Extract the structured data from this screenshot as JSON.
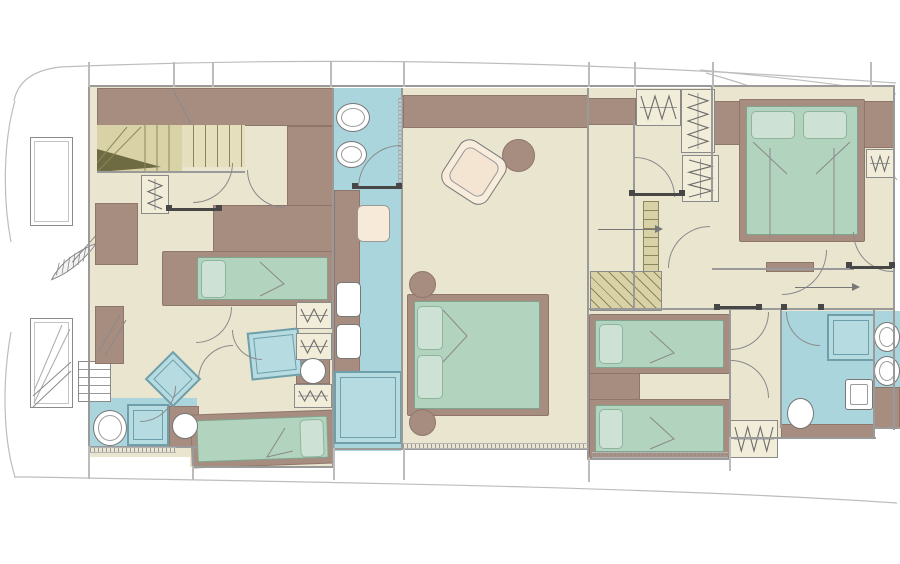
{
  "canvas": {
    "w": 900,
    "h": 564,
    "bg": "#ffffff"
  },
  "palette": {
    "cream": "#e9e5cf",
    "cream2": "#f1edd9",
    "brown": "#a78c80",
    "brown_edge": "#8f766b",
    "green": "#b2d3bd",
    "green_edge": "#7fa590",
    "pillow": "#cde2d5",
    "pillow_edge": "#8fb49e",
    "blue": "#aad5dc",
    "blue_deep": "#b6dbe1",
    "shower_edge": "#6f9faa",
    "khaki": "#d9d2a6",
    "khaki_light": "#e6dfbd",
    "khaki_dark": "#6e6a42",
    "khaki_line": "#8b865c",
    "wall": "#9a9a9a",
    "wall_light": "#bcbcbc",
    "line": "#8a8a8a",
    "dark": "#474747",
    "white": "#ffffff",
    "seat": "#f7ead9",
    "hull": "#bdbdbd",
    "arrow": "#777777"
  },
  "hull_paths": [
    {
      "n": "hull-sheer-top",
      "d": "M896,83 C560,59 300,57 60,67 C35,70 18,80 14,101"
    },
    {
      "n": "hull-bow-upper",
      "d": "M15,101 C4,138 2,195 11,242"
    },
    {
      "n": "hull-bow-lower",
      "d": "M11,332 C2,382 3,438 15,477"
    },
    {
      "n": "hull-sheer-bottom",
      "d": "M897,503 C640,486 300,482 30,477 L14,477"
    },
    {
      "n": "hull-stern-line",
      "d": "M700,70 C790,78 858,87 896,94"
    },
    {
      "n": "hull-chine",
      "d": "M706,73 C800,98 868,138 897,180"
    }
  ],
  "floors": [
    {
      "n": "forward-cabin-floor",
      "x": 90,
      "y": 87,
      "w": 243,
      "h": 370,
      "f": "cream"
    },
    {
      "n": "forward-ext-floor",
      "x": 190,
      "y": 400,
      "w": 143,
      "h": 67,
      "f": "cream"
    },
    {
      "n": "master-bath-floor",
      "x": 334,
      "y": 88,
      "w": 67,
      "h": 363,
      "f": "blue"
    },
    {
      "n": "master-cabin-floor",
      "x": 403,
      "y": 88,
      "w": 185,
      "h": 362,
      "f": "cream"
    },
    {
      "n": "stair-lobby-floor",
      "x": 588,
      "y": 88,
      "w": 124,
      "h": 222,
      "f": "cream"
    },
    {
      "n": "corridor-floor",
      "x": 634,
      "y": 198,
      "w": 260,
      "h": 113,
      "f": "cream"
    },
    {
      "n": "vip-cabin-floor",
      "x": 712,
      "y": 87,
      "w": 182,
      "h": 184,
      "f": "cream"
    },
    {
      "n": "twin-cabin-floor",
      "x": 588,
      "y": 310,
      "w": 142,
      "h": 150,
      "f": "cream"
    },
    {
      "n": "aft-lobby-floor",
      "x": 730,
      "y": 310,
      "w": 52,
      "h": 128,
      "f": "cream"
    },
    {
      "n": "aft-bath-floor",
      "x": 781,
      "y": 311,
      "w": 94,
      "h": 116,
      "f": "blue"
    },
    {
      "n": "starboard-bath-floor",
      "x": 874,
      "y": 311,
      "w": 26,
      "h": 118,
      "f": "blue"
    },
    {
      "n": "forward-bath-floor",
      "x": 90,
      "y": 398,
      "w": 107,
      "h": 50,
      "f": "blue"
    }
  ],
  "blocks": [
    {
      "n": "forward-cabinet-band",
      "x": 97,
      "y": 88,
      "w": 236,
      "h": 38
    },
    {
      "n": "forward-cabinet-right",
      "x": 287,
      "y": 126,
      "w": 46,
      "h": 106
    },
    {
      "n": "forward-cabinet-left",
      "x": 95,
      "y": 203,
      "w": 43,
      "h": 62
    },
    {
      "n": "forward-mid-cabinet",
      "x": 213,
      "y": 205,
      "w": 120,
      "h": 48
    },
    {
      "n": "mirror-panel",
      "x": 95,
      "y": 306,
      "w": 29,
      "h": 58
    },
    {
      "n": "master-cabinet-band",
      "x": 403,
      "y": 95,
      "w": 185,
      "h": 33
    },
    {
      "n": "master-bath-counter",
      "x": 334,
      "y": 190,
      "w": 26,
      "h": 182
    },
    {
      "n": "lobby-cabinet",
      "x": 588,
      "y": 98,
      "w": 48,
      "h": 27
    },
    {
      "n": "vip-headboard-left",
      "x": 712,
      "y": 101,
      "w": 29,
      "h": 44
    },
    {
      "n": "vip-headboard-right",
      "x": 860,
      "y": 101,
      "w": 34,
      "h": 47
    },
    {
      "n": "vip-bench",
      "x": 766,
      "y": 262,
      "w": 48,
      "h": 10
    },
    {
      "n": "twin-nightstand",
      "x": 589,
      "y": 372,
      "w": 51,
      "h": 29
    },
    {
      "n": "aft-bath-counter",
      "x": 781,
      "y": 424,
      "w": 94,
      "h": 15
    },
    {
      "n": "starboard-bath-counter",
      "x": 873,
      "y": 387,
      "w": 27,
      "h": 42
    },
    {
      "n": "toilet-surround-forward",
      "x": 169,
      "y": 406,
      "w": 30,
      "h": 42
    },
    {
      "n": "toilet-surround-mid",
      "x": 296,
      "y": 354,
      "w": 34,
      "h": 30
    }
  ],
  "stairs": [
    {
      "n": "forward-stairs-winder",
      "t": "winder",
      "x": 97,
      "y": 125,
      "w": 85,
      "h": 47
    },
    {
      "n": "forward-stairs-treads",
      "t": "tv",
      "x": 182,
      "y": 125,
      "w": 63,
      "h": 42
    },
    {
      "n": "aft-stairs-strip",
      "t": "th",
      "x": 643,
      "y": 201,
      "w": 16,
      "h": 71
    },
    {
      "n": "aft-staircase",
      "t": "hatch",
      "x": 590,
      "y": 271,
      "w": 72,
      "h": 40
    }
  ],
  "beds": [
    {
      "n": "forward-single-bed",
      "x": 162,
      "y": 251,
      "w": 171,
      "h": 55,
      "mi": [
        34,
        5,
        4,
        5
      ],
      "p": [
        {
          "x": 38,
          "y": 8,
          "w": 25,
          "h": 38
        }
      ]
    },
    {
      "n": "forward-lower-bed",
      "x": 191,
      "y": 412,
      "w": 143,
      "h": 54,
      "r": -2,
      "mi": [
        5,
        5,
        5,
        5
      ],
      "p": [
        {
          "x": 108,
          "y": 8,
          "w": 24,
          "h": 38
        }
      ]
    },
    {
      "n": "master-bed",
      "x": 407,
      "y": 294,
      "w": 142,
      "h": 122,
      "mi": [
        6,
        6,
        8,
        6
      ],
      "p": [
        {
          "x": 9,
          "y": 11,
          "w": 26,
          "h": 44
        },
        {
          "x": 9,
          "y": 60,
          "w": 26,
          "h": 44
        }
      ]
    },
    {
      "n": "vip-bed",
      "x": 739,
      "y": 99,
      "w": 126,
      "h": 143,
      "mi": [
        6,
        6,
        6,
        6
      ],
      "p": [
        {
          "x": 11,
          "y": 11,
          "w": 44,
          "h": 28
        },
        {
          "x": 63,
          "y": 11,
          "w": 44,
          "h": 28
        }
      ]
    },
    {
      "n": "twin-bed-upper",
      "x": 589,
      "y": 314,
      "w": 141,
      "h": 60,
      "mi": [
        5,
        5,
        5,
        5
      ],
      "p": [
        {
          "x": 9,
          "y": 9,
          "w": 24,
          "h": 40
        }
      ]
    },
    {
      "n": "twin-bed-lower",
      "x": 589,
      "y": 399,
      "w": 141,
      "h": 59,
      "mi": [
        5,
        5,
        5,
        5
      ],
      "p": [
        {
          "x": 9,
          "y": 9,
          "w": 24,
          "h": 40
        }
      ]
    }
  ],
  "closets": [
    {
      "n": "forward-wardrobe",
      "x": 141,
      "y": 175,
      "w": 28,
      "h": 39,
      "d": "v"
    },
    {
      "n": "mid-wardrobe-1",
      "x": 296,
      "y": 302,
      "w": 36,
      "h": 27,
      "d": "h"
    },
    {
      "n": "mid-wardrobe-2",
      "x": 296,
      "y": 333,
      "w": 36,
      "h": 27,
      "d": "h"
    },
    {
      "n": "mid-wardrobe-3",
      "x": 294,
      "y": 384,
      "w": 38,
      "h": 24,
      "d": "h"
    },
    {
      "n": "lobby-closet-1",
      "x": 636,
      "y": 89,
      "w": 45,
      "h": 37,
      "d": "h"
    },
    {
      "n": "lobby-closet-2",
      "x": 681,
      "y": 89,
      "w": 34,
      "h": 64,
      "d": "v"
    },
    {
      "n": "lobby-closet-3",
      "x": 682,
      "y": 155,
      "w": 37,
      "h": 47,
      "d": "v"
    },
    {
      "n": "twin-wardrobe",
      "x": 730,
      "y": 420,
      "w": 48,
      "h": 38,
      "d": "h"
    },
    {
      "n": "vip-closet",
      "x": 866,
      "y": 149,
      "w": 28,
      "h": 29,
      "d": "h"
    }
  ],
  "showers": [
    {
      "n": "forward-shower",
      "x": 127,
      "y": 404,
      "w": 42,
      "h": 42
    },
    {
      "n": "master-shower",
      "x": 334,
      "y": 371,
      "w": 68,
      "h": 73
    },
    {
      "n": "aft-shower",
      "x": 827,
      "y": 314,
      "w": 48,
      "h": 47
    },
    {
      "n": "mid-shower-diamond",
      "x": 153,
      "y": 359,
      "w": 40,
      "h": 40,
      "r": 45
    },
    {
      "n": "mid-shower-quad",
      "x": 249,
      "y": 330,
      "w": 52,
      "h": 48,
      "r": -6
    }
  ],
  "sinks": [
    {
      "n": "forward-sink",
      "t": "oval",
      "x": 93,
      "y": 410,
      "w": 34,
      "h": 36
    },
    {
      "n": "master-sink-1",
      "t": "oval",
      "x": 336,
      "y": 103,
      "w": 34,
      "h": 29
    },
    {
      "n": "master-sink-2",
      "t": "oval",
      "x": 336,
      "y": 141,
      "w": 31,
      "h": 27
    },
    {
      "n": "starboard-sink-1",
      "t": "oval",
      "x": 874,
      "y": 322,
      "w": 26,
      "h": 30
    },
    {
      "n": "starboard-sink-2",
      "t": "oval",
      "x": 874,
      "y": 356,
      "w": 26,
      "h": 30
    },
    {
      "n": "aft-vanity-sink",
      "t": "sq",
      "x": 845,
      "y": 379,
      "w": 28,
      "h": 31
    }
  ],
  "toilets": [
    {
      "n": "forward-toilet",
      "t": "circle",
      "x": 172,
      "y": 413,
      "w": 26,
      "h": 26
    },
    {
      "n": "mid-toilet",
      "t": "circle",
      "x": 300,
      "y": 358,
      "w": 26,
      "h": 26
    },
    {
      "n": "aft-toilet",
      "t": "oval",
      "x": 787,
      "y": 398,
      "w": 27,
      "h": 31
    },
    {
      "n": "master-wc",
      "t": "fix",
      "x": 336,
      "y": 282,
      "w": 25,
      "h": 35
    },
    {
      "n": "master-bidet",
      "t": "fix",
      "x": 336,
      "y": 324,
      "w": 25,
      "h": 35
    }
  ],
  "round_tables": [
    {
      "n": "master-side-table-top",
      "x": 409,
      "y": 271,
      "d": 27
    },
    {
      "n": "master-side-table-bottom",
      "x": 409,
      "y": 409,
      "d": 27
    },
    {
      "n": "master-coffee-table",
      "x": 502,
      "y": 139,
      "d": 33
    }
  ],
  "seats": [
    {
      "n": "master-bath-seat",
      "t": "seat",
      "x": 357,
      "y": 205,
      "w": 33,
      "h": 37
    },
    {
      "n": "master-armchair",
      "t": "chair",
      "x": 447,
      "y": 145,
      "w": 54,
      "h": 54,
      "r": 33
    }
  ],
  "lockers": [
    {
      "n": "bow-locker-1",
      "t": "locker",
      "x": 30,
      "y": 137,
      "w": 43,
      "h": 89
    },
    {
      "n": "bow-locker-2",
      "t": "locker",
      "x": 30,
      "y": 318,
      "w": 43,
      "h": 90,
      "diag": true
    },
    {
      "n": "bow-ladder",
      "t": "ladder",
      "x": 78,
      "y": 361,
      "w": 33,
      "h": 41
    }
  ],
  "feather": {
    "n": "bow-hatch-grating",
    "x": 44,
    "y": 244,
    "w": 62,
    "h": 34,
    "rot": -25,
    "outline": "M2,24 Q22,8 58,10 Q28,26 2,24 Z",
    "stem": "M28,17 L60,3",
    "hatch": "M8,22 L16,12 M14,23 L22,11 M20,23 L28,11 M26,23 L34,10 M32,22 L40,10 M38,21 L46,10"
  },
  "walls_h": [
    [
      88,
      85,
      807
    ],
    [
      97,
      171,
      148
    ],
    [
      88,
      446,
      110
    ],
    [
      192,
      466,
      142
    ],
    [
      333,
      448,
      256
    ],
    [
      588,
      458,
      143
    ],
    [
      729,
      437,
      147
    ],
    [
      874,
      427,
      26
    ],
    [
      588,
      308,
      307
    ],
    [
      712,
      268,
      142
    ]
  ],
  "walls_v": [
    [
      88,
      85,
      363
    ],
    [
      332,
      88,
      360
    ],
    [
      401,
      88,
      361
    ],
    [
      587,
      88,
      372
    ],
    [
      633,
      120,
      190
    ],
    [
      711,
      85,
      117
    ],
    [
      729,
      310,
      129
    ],
    [
      780,
      310,
      118
    ],
    [
      873,
      310,
      119
    ],
    [
      893,
      85,
      345
    ],
    [
      192,
      446,
      22
    ],
    [
      332,
      448,
      18
    ],
    [
      587,
      448,
      12
    ],
    [
      729,
      437,
      23
    ],
    [
      873,
      427,
      12
    ]
  ],
  "stubs_top": [
    88,
    173,
    212,
    330,
    403,
    588,
    634,
    712,
    870
  ],
  "stubs_bottom": [
    [
      88,
      446,
      33
    ],
    [
      192,
      466,
      14
    ],
    [
      333,
      448,
      32
    ],
    [
      403,
      448,
      32
    ],
    [
      588,
      458,
      24
    ],
    [
      729,
      437,
      34
    ]
  ],
  "door_arcs": [
    {
      "cx": 193,
      "cy": 163,
      "r": 40,
      "p": "tl"
    },
    {
      "cx": 285,
      "cy": 170,
      "r": 38,
      "p": "tr"
    },
    {
      "cx": 401,
      "cy": 188,
      "r": 43,
      "p": "br"
    },
    {
      "cx": 635,
      "cy": 197,
      "r": 40,
      "p": "bl"
    },
    {
      "cx": 710,
      "cy": 268,
      "r": 42,
      "p": "br"
    },
    {
      "cx": 731,
      "cy": 312,
      "r": 38,
      "p": "tl"
    },
    {
      "cx": 820,
      "cy": 312,
      "r": 34,
      "p": "tr"
    },
    {
      "cx": 782,
      "cy": 250,
      "r": 45,
      "p": "tl"
    },
    {
      "cx": 893,
      "cy": 232,
      "r": 40,
      "p": "tr"
    },
    {
      "cx": 731,
      "cy": 398,
      "r": 38,
      "p": "bl"
    },
    {
      "cx": 196,
      "cy": 307,
      "r": 36,
      "p": "tl"
    },
    {
      "cx": 233,
      "cy": 380,
      "r": 35,
      "p": "br"
    },
    {
      "cx": 262,
      "cy": 330,
      "r": 30,
      "p": "tr"
    },
    {
      "cx": 140,
      "cy": 386,
      "r": 36,
      "p": "tl"
    }
  ],
  "door_bars": [
    [
      358,
      186,
      44
    ],
    [
      633,
      193,
      50
    ],
    [
      170,
      208,
      48
    ],
    [
      718,
      306,
      42
    ],
    [
      850,
      266,
      42
    ]
  ],
  "door_posts": [
    [
      352,
      183
    ],
    [
      396,
      183
    ],
    [
      629,
      190
    ],
    [
      679,
      190
    ],
    [
      714,
      304
    ],
    [
      756,
      304
    ],
    [
      781,
      304
    ],
    [
      818,
      304
    ],
    [
      846,
      262
    ],
    [
      889,
      262
    ],
    [
      166,
      205
    ],
    [
      216,
      205
    ]
  ],
  "window_strips": [
    {
      "x": 403,
      "y": 443,
      "w": 185,
      "h": 6,
      "o": "h"
    },
    {
      "x": 90,
      "y": 447,
      "w": 86,
      "h": 6,
      "o": "h"
    },
    {
      "x": 592,
      "y": 452,
      "w": 136,
      "h": 6,
      "o": "h"
    },
    {
      "x": 398,
      "y": 98,
      "w": 4,
      "h": 92,
      "o": "v"
    }
  ],
  "arrows": [
    {
      "n": "stair-direction-arrow",
      "x": 598,
      "y": 229,
      "len": 58
    },
    {
      "n": "corridor-direction-arrow",
      "x": 795,
      "y": 287,
      "len": 58
    }
  ],
  "decor_paths": [
    {
      "n": "blanket-fold-master",
      "d": "M443,310 L467,336 L443,362"
    },
    {
      "n": "blanket-fold-vip-left",
      "d": "M753,142 L787,174"
    },
    {
      "n": "blanket-fold-vip-right",
      "d": "M850,142 L816,174"
    },
    {
      "n": "vip-bed-seam-left",
      "d": "M770,148 L770,238"
    },
    {
      "n": "vip-bed-seam-right",
      "d": "M834,148 L834,238"
    },
    {
      "n": "blanket-fold-twin-upper",
      "d": "M650,331 L674,353 L650,363"
    },
    {
      "n": "blanket-fold-twin-lower",
      "d": "M650,417 L674,439 L650,449"
    },
    {
      "n": "blanket-fold-forward",
      "d": "M260,262 L284,284 L260,296"
    },
    {
      "n": "blanket-fold-lower",
      "d": "M285,428 L267,457 L293,451"
    },
    {
      "n": "upper-stair-line",
      "d": "M173,90 L191,124"
    },
    {
      "n": "mirror-slash-1",
      "d": "M99,351 L120,315"
    },
    {
      "n": "mirror-slash-2",
      "d": "M105,356 L126,320"
    },
    {
      "n": "ladder-diag-1",
      "d": "M33,396 L71,362"
    },
    {
      "n": "ladder-diag-2",
      "d": "M33,407 L71,371"
    }
  ]
}
